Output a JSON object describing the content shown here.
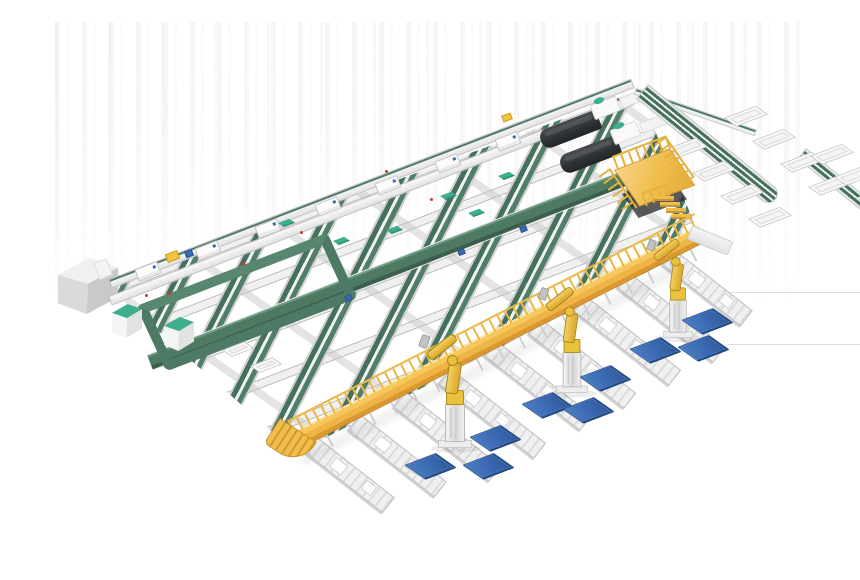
{
  "scene": {
    "description": "Isometric 3D rendering of an automated parcel sorting and robot palletizing facility on a white background",
    "background_color": "#ffffff",
    "visible_text": [],
    "regions": {
      "sorting_grid": {
        "label": "cross-belt sorting grid with inclined green belt conveyors",
        "rail_count": 6,
        "sorter_carriage_count": 7
      },
      "infeed": {
        "label": "infeed line with gray scanner cabinet"
      },
      "loop": {
        "label": "dark green recirculation loop conveyor with two teal-top cabinets",
        "cabinet_count": 2
      },
      "machines": {
        "label": "dark gray processing machines with white heads",
        "count": 2
      },
      "operator_platform": {
        "label": "yellow operator platform with guard rail and stairs"
      },
      "walkway": {
        "label": "yellow elevated maintenance walkway with guard rail, support legs and end stairs"
      },
      "outfeed": {
        "label": "multi-lane green outfeed conveyor with white packing tables",
        "table_count": 13
      },
      "roller_lanes": {
        "label": "roller discharge lanes with white parcels",
        "count": 9
      },
      "palletizing": {
        "label": "yellow palletizing robots and blue pallets on floor",
        "robot_count": 3,
        "pallet_count": 9
      }
    },
    "colors": {
      "conveyor_green": "#4e7a63",
      "belt_dark_green": "#3c5f4d",
      "belt_light_green": "#517e68",
      "frame_light_gray": "#f0f0f0",
      "frame_mid_gray": "#bdbdbd",
      "accent_teal": "#3fae8f",
      "walkway_yellow": "#f2c049",
      "walkway_shade": "#d9992f",
      "robot_yellow": "#e8c23c",
      "pallet_blue": "#3a69b2",
      "machine_dark": "#2f3235",
      "cabinet_gray": "#d6d6d6",
      "marker_red": "#c23b2e",
      "marker_blue": "#3a69b0"
    }
  }
}
